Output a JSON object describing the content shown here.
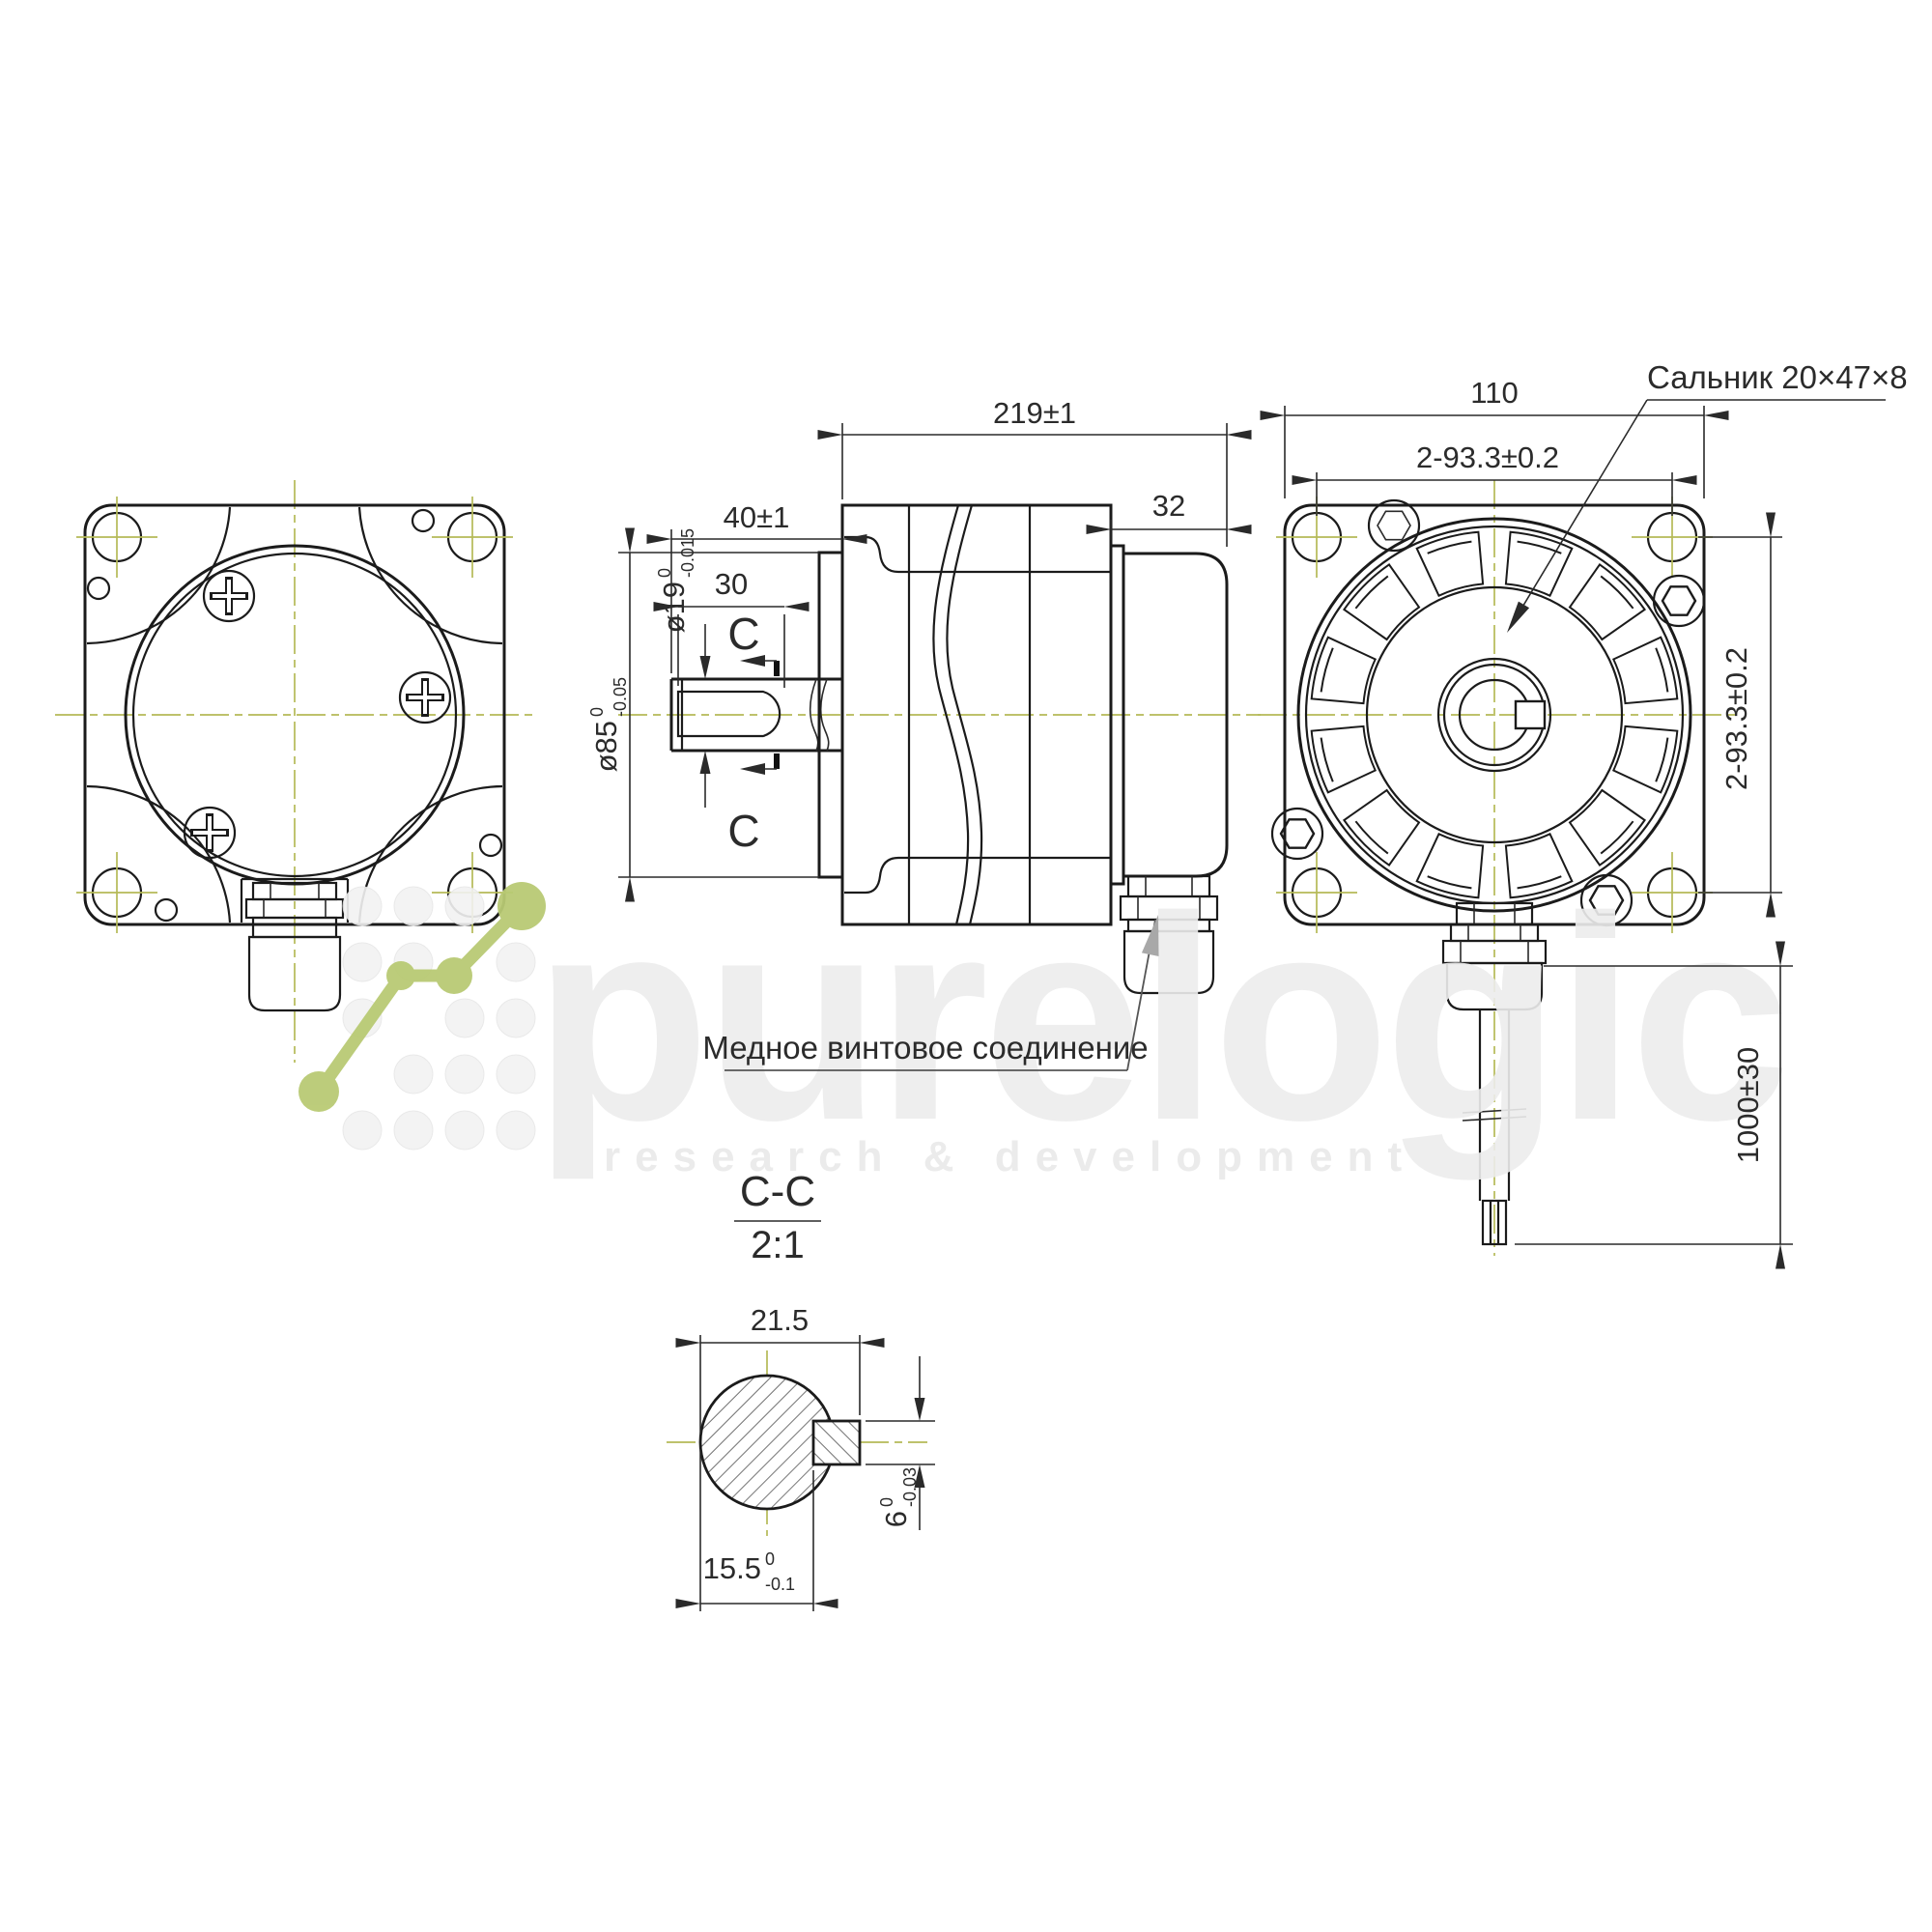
{
  "drawing": {
    "annotations": {
      "seal_label": "Сальник 20×47×8",
      "connection_label": "Медное винтовое соединение",
      "section_title": "C-C",
      "section_scale": "2:1",
      "cut_letter": "C"
    },
    "dimensions": {
      "overall_length": "219±1",
      "shaft_length": "40±1",
      "keyway_length": "30",
      "rear_cap_width": "32",
      "shaft_dia": {
        "main": "ø19",
        "sup": "0",
        "sub": "-0.015"
      },
      "pilot_dia": {
        "main": "ø85",
        "sup": "0",
        "sub": "-0.05"
      },
      "flange_size": "110",
      "hole_spacing_h": "2-93.3±0.2",
      "hole_spacing_v": "2-93.3±0.2",
      "cable_length": "1000±30",
      "key_section_width": "21.5",
      "key_flat": {
        "main": "15.5",
        "sup": "0",
        "sub": "-0.1"
      },
      "key_height": {
        "main": "6",
        "sup": "0",
        "sub": "-0.03"
      }
    },
    "watermark": {
      "word": "purelogic",
      "tagline": "research & development"
    },
    "colors": {
      "centerline": "#b5ba57",
      "line": "#1b1b1b",
      "dim": "#2a2a2a",
      "watermark_green": "#b9ca74"
    }
  }
}
